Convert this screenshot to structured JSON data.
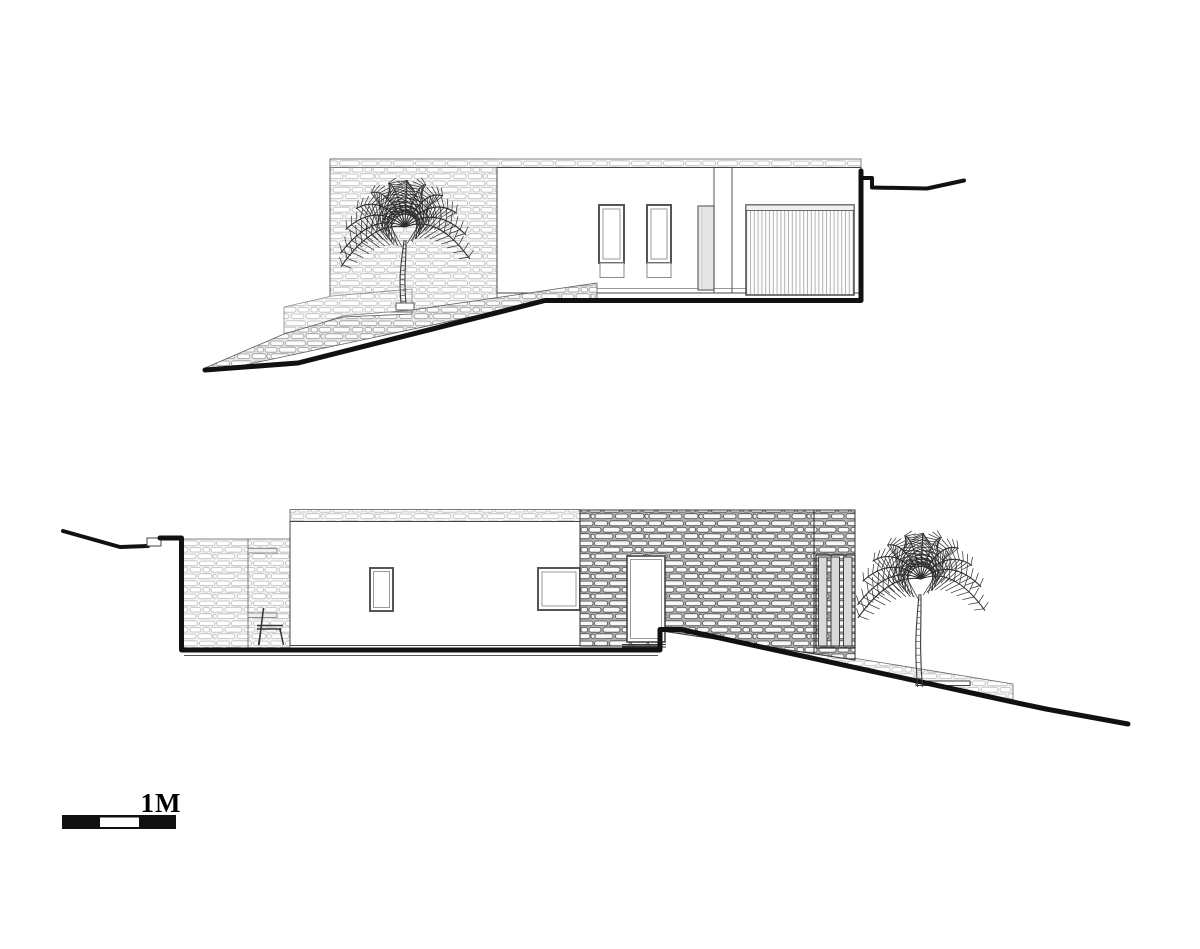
{
  "scale_bar": {
    "label": "1M",
    "bar_color": "#111111",
    "gap_color": "#ffffff"
  },
  "palette": {
    "background": "#ffffff",
    "outline": "#3a3a3a",
    "ground_line": "#111111",
    "stone_light": "#f4f4f4",
    "stone_mid": "#e7e7e7",
    "stone_dark_mortar": "#aeaeae",
    "glazing": "#e6e6e6"
  }
}
